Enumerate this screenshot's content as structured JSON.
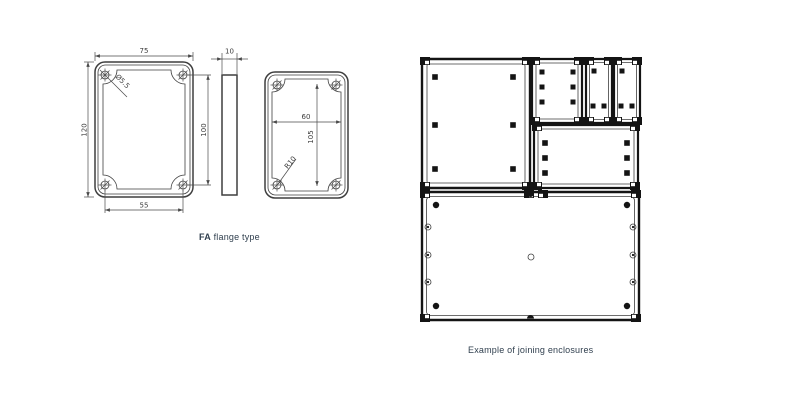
{
  "captions": {
    "flange_label_bold": "FA",
    "flange_label_rest": " flange type",
    "joining_caption": "Example of joining enclosures"
  },
  "flange_drawing": {
    "front_view": {
      "outer_width": "75",
      "outer_height": "120",
      "hole_pitch_vertical": "100",
      "hole_pitch_horizontal": "55",
      "hole_diameter": "Ø5.5"
    },
    "side_view": {
      "thickness": "10"
    },
    "back_view": {
      "inner_width": "60",
      "inner_height": "105",
      "corner_radius": "R10"
    }
  },
  "colors": {
    "background": "#ffffff",
    "drawing_line": "#3f3f3f",
    "dimension_line": "#4a4a4a",
    "enclosure_line": "#141414",
    "caption_text": "#31404f"
  }
}
